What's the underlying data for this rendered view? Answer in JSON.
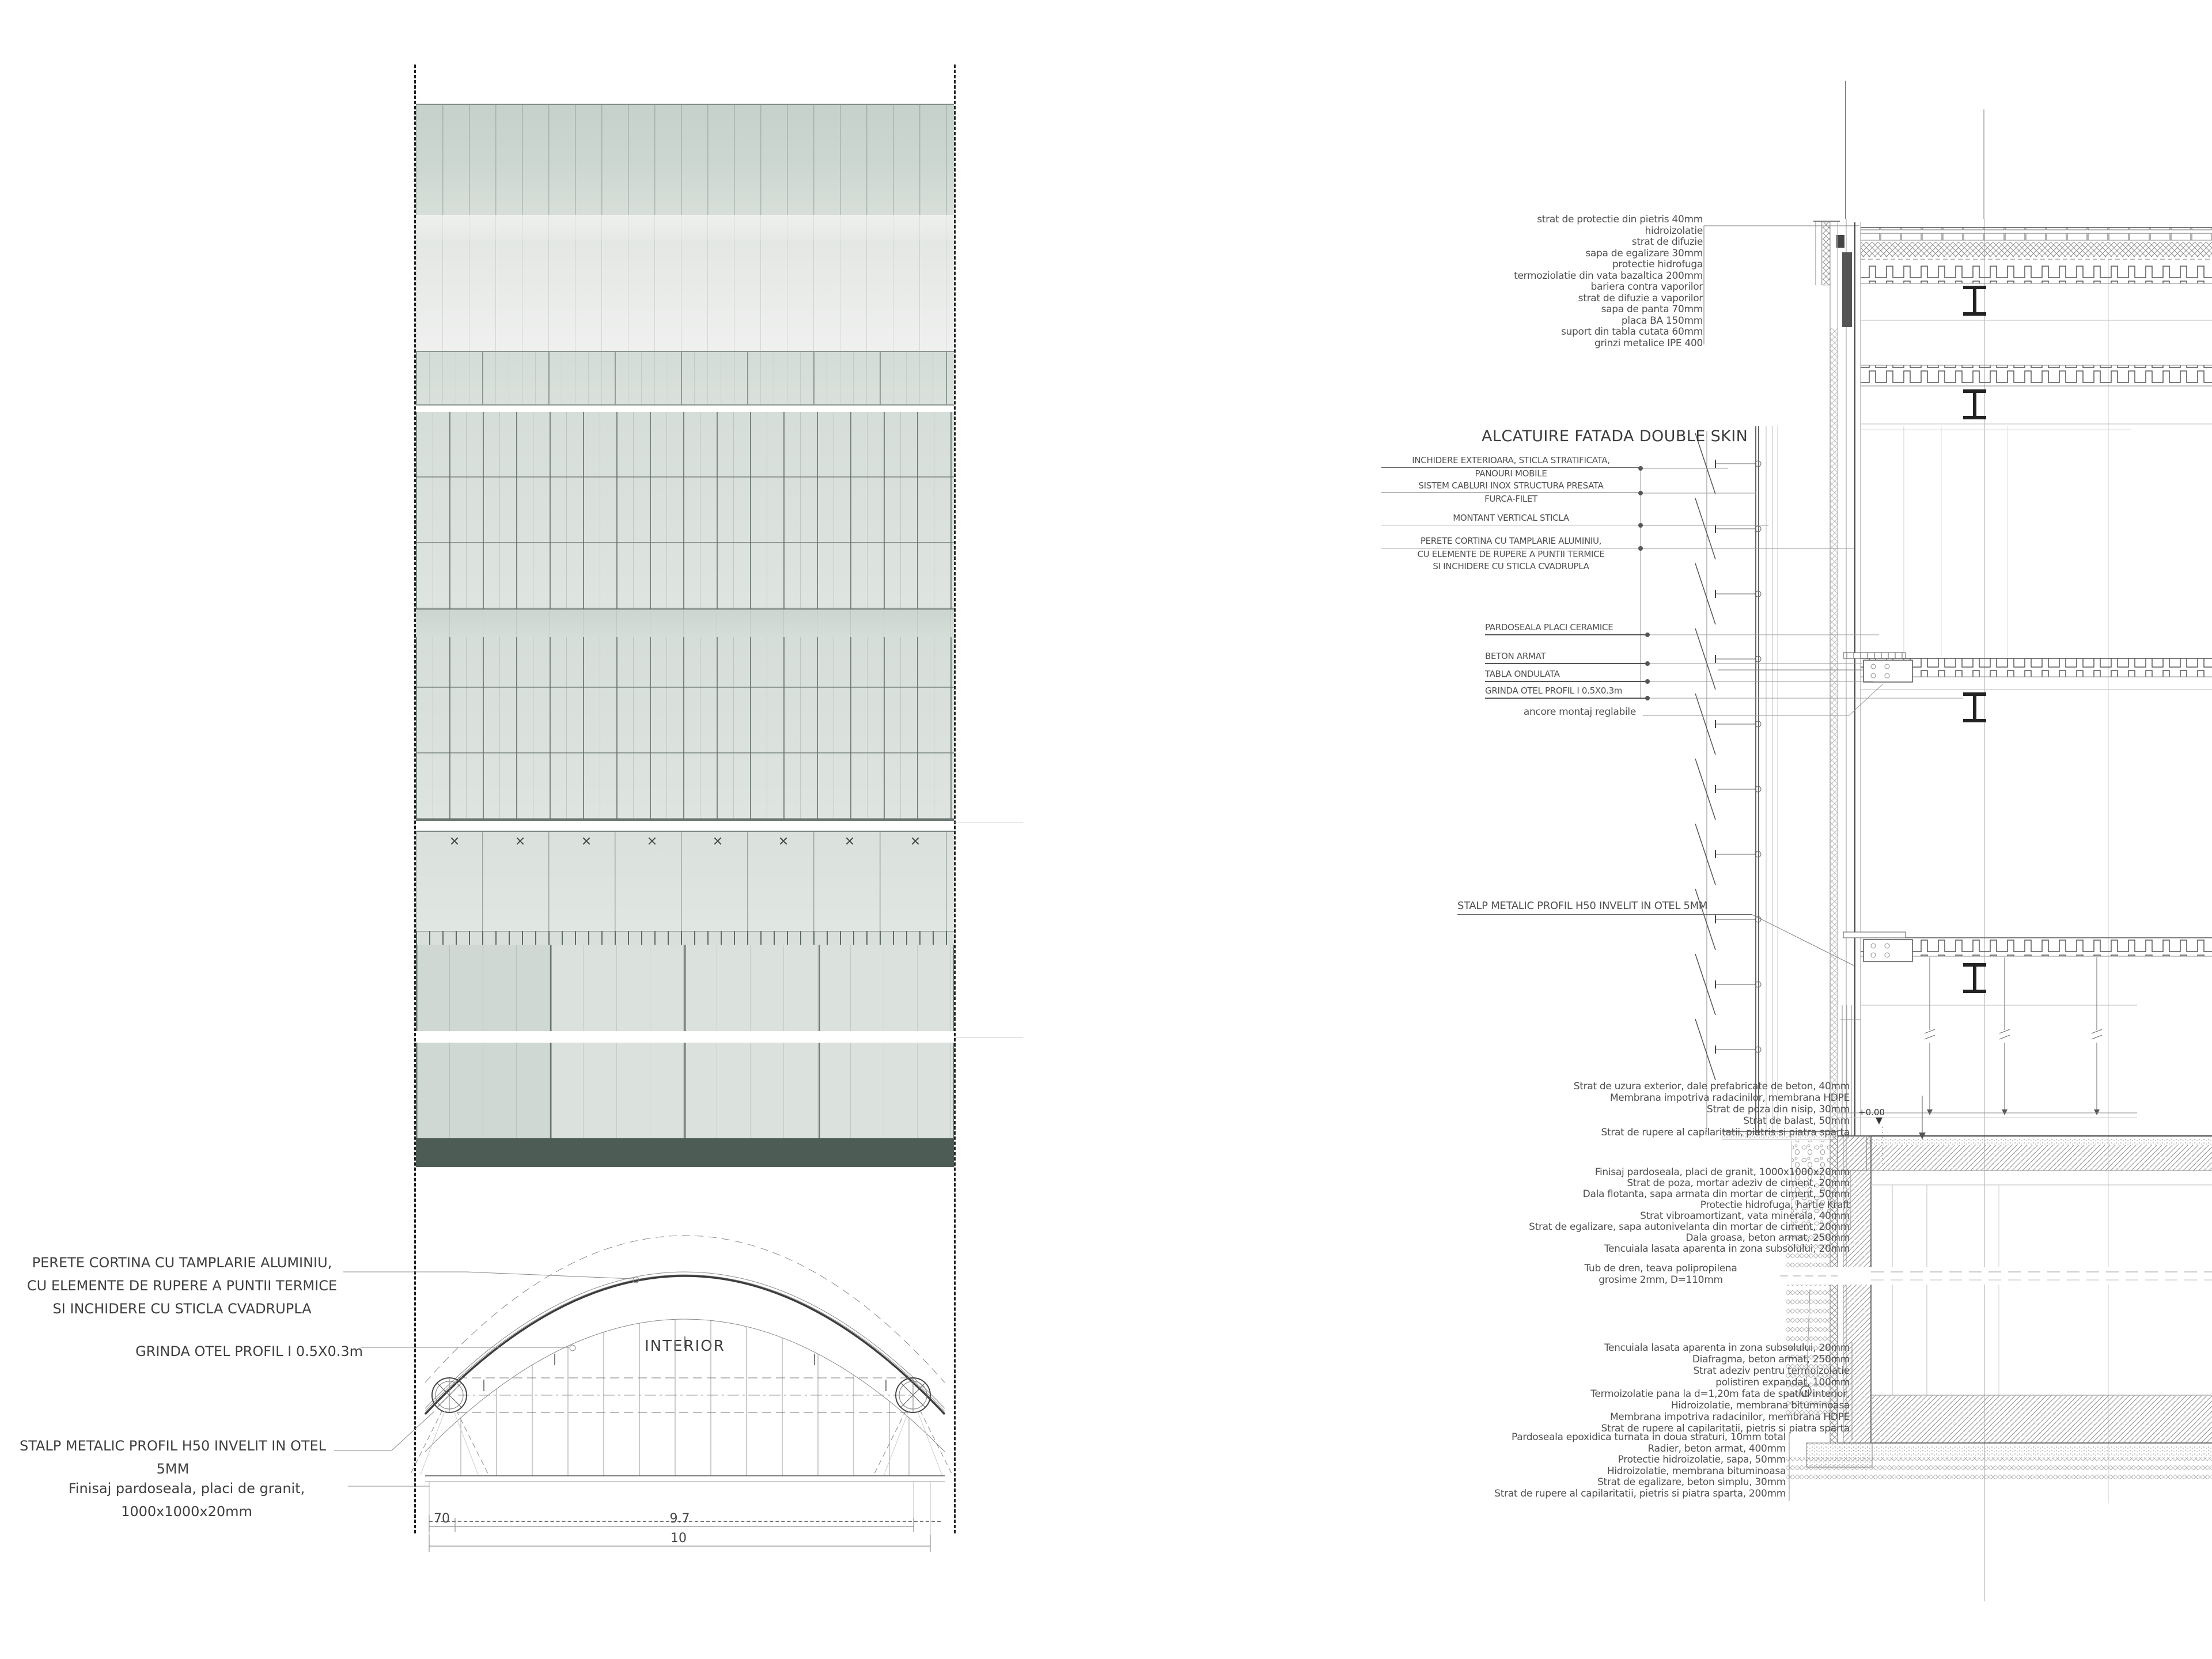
{
  "colors": {
    "background": "#ffffff",
    "line_dark": "#3d3d3d",
    "line_mid": "#777777",
    "annotation_text": "#4a4a4a",
    "glass_tint_top": "#c9d4ce",
    "glass_tint_grid": "#d6ded9",
    "glass_pale": "#eceeec",
    "plinth_dark": "#4e5c56"
  },
  "left_elevation": {
    "zone_labels": {
      "exterior": "EXTERIOR",
      "interior": "INTERIOR"
    },
    "callouts": {
      "perete": {
        "lines": [
          "PERETE CORTINA CU TAMPLARIE ALUMINIU,",
          "CU ELEMENTE DE RUPERE A PUNTII TERMICE",
          "SI INCHIDERE CU STICLA CVADRUPLA"
        ]
      },
      "grinda": "GRINDA OTEL PROFIL I  0.5X0.3m",
      "stalp": {
        "lines": [
          "STALP METALIC PROFIL H50 INVELIT IN OTEL",
          "5MM"
        ]
      },
      "finisaj": {
        "lines": [
          "Finisaj pardoseala, placi de granit,",
          "1000x1000x20mm"
        ]
      }
    },
    "dimensions": {
      "seg_small": "70",
      "seg_main": "9.7",
      "total": "10"
    }
  },
  "right_section": {
    "facade_title": "ALCATUIRE FATADA DOUBLE SKIN",
    "roof_layers": [
      "strat de protectie din pietris 40mm",
      "hidroizolatie",
      "strat de difuzie",
      "sapa de egalizare 30mm",
      "protectie hidrofuga",
      "termoziolatie din vata bazaltica 200mm",
      "bariera contra vaporilor",
      "strat de difuzie a vaporilor",
      "sapa de panta 70mm",
      "placa BA 150mm",
      "suport din tabla cutata 60mm",
      "grinzi metalice IPE 400"
    ],
    "facade_callouts": [
      {
        "lines": [
          "INCHIDERE EXTERIOARA, STICLA STRATIFICATA,",
          "PANOURI MOBILE"
        ]
      },
      {
        "lines": [
          "SISTEM CABLURI INOX STRUCTURA PRESATA",
          "FURCA-FILET"
        ]
      },
      {
        "lines": [
          "MONTANT VERTICAL STICLA"
        ]
      },
      {
        "lines": [
          "PERETE CORTINA CU TAMPLARIE ALUMINIU,",
          "CU ELEMENTE DE RUPERE A PUNTII TERMICE",
          "SI INCHIDERE CU STICLA CVADRUPLA"
        ]
      }
    ],
    "floor_callouts": [
      "PARDOSEALA PLACI CERAMICE",
      "BETON ARMAT",
      "TABLA ONDULATA",
      "GRINDA OTEL PROFIL I  0.5X0.3m"
    ],
    "anchor_callout": "ancore montaj reglabile",
    "stalp_callout": "STALP METALIC PROFIL H50 INVELIT IN OTEL 5MM",
    "terrace_layers": [
      "Strat de uzura exterior, dale prefabricate de beton, 40mm",
      "Membrana impotriva radacinilor, membrana HDPE",
      "Strat de poza din nisip, 30mm",
      "Strat de balast, 50mm",
      "Strat de rupere al capilaritatii, pietris si piatra sparta"
    ],
    "ground_floor_layers": [
      "Finisaj pardoseala, placi de granit, 1000x1000x20mm",
      "Strat de poza, mortar adeziv de ciment, 20mm",
      "Dala flotanta, sapa armata din mortar de ciment, 50mm",
      "Protectie hidrofuga, hartie Kraft",
      "Strat vibroamortizant, vata minerala, 40mm",
      "Strat de egalizare, sapa autonivelanta din mortar de ciment, 20mm",
      "Dala groasa, beton armat, 250mm",
      "Tencuiala lasata aparenta in zona subsolului, 20mm"
    ],
    "drain_callout": {
      "lines": [
        "Tub de dren, teava polipropilena",
        "grosime 2mm, D=110mm"
      ]
    },
    "basement_wall_layers": [
      "Tencuiala lasata aparenta in zona subsolului, 20mm",
      "Diafragma, beton armat, 250mm",
      "Strat adeziv pentru termoizolatie",
      "polistiren expandat, 100mm",
      "Termoizolatie pana la d=1,20m fata de spatiul interior,",
      "Hidroizolatie, membrana bituminoasa",
      "Membrana impotriva radacinilor, membrana HDPE",
      "Strat de rupere al capilaritatii, pietris si piatra sparta"
    ],
    "foundation_layers": [
      "Pardoseala epoxidica turnata in doua straturi, 10mm total",
      "Radier, beton armat, 400mm",
      "Protectie hidroizolatie, sapa, 50mm",
      "Hidroizolatie, membrana bituminoasa",
      "Strat de egalizare, beton simplu, 30mm",
      "Strat de rupere al capilaritatii, pietris si piatra sparta, 200mm"
    ],
    "level_marker": "+0.00"
  }
}
